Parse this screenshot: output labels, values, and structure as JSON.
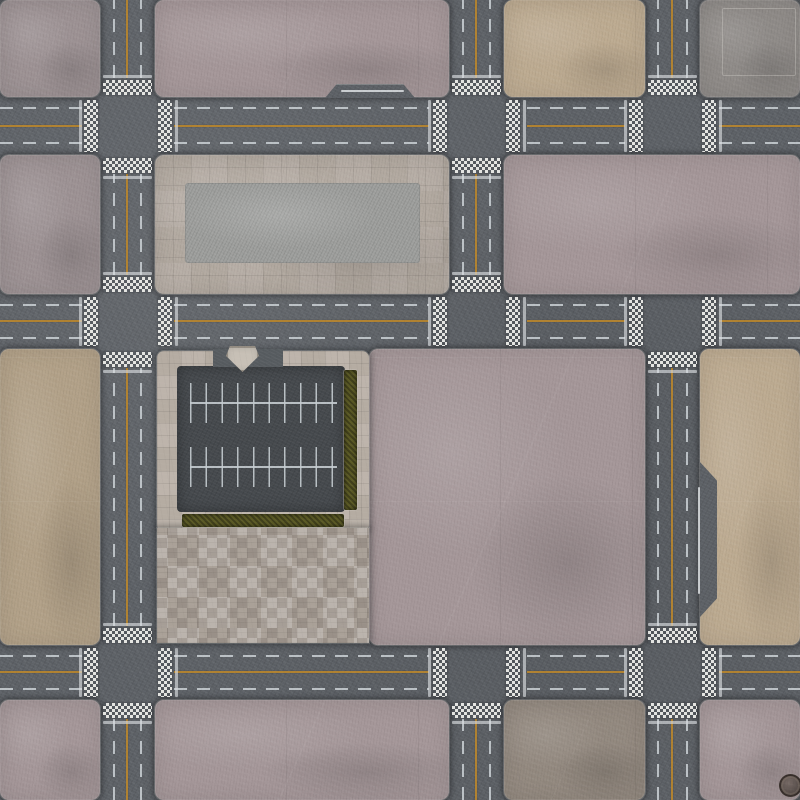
{
  "scene": {
    "title": "city-streets-gaming-mat",
    "width": 800,
    "height": 800,
    "description": "top-down asphalt street grid with concrete city blocks, crosswalks, parking lot, plazas"
  },
  "palette": {
    "asphalt": "#5c6065",
    "parking_asphalt": "#45494d",
    "center_line_yellow": "#b5842f",
    "lane_dash_white": "#ccd2d6",
    "crosswalk_white": "#f0f0ec",
    "block_pink_grey": "#9d9294",
    "block_mauve": "#a59799",
    "block_tan": "#bdab91",
    "block_sand": "#b2a188",
    "block_concrete_grey": "#8f8b88",
    "block_grey_brown": "#93897f",
    "plaza_tile": "#b2a9a0",
    "plaza_pad": "#9d9e9c",
    "paver_sidewalk": "#b5aca2",
    "mosaic_tile": "#aaa198",
    "hedge_green": "#5b5a26"
  },
  "blocks": [
    {
      "name": "block-a1",
      "type": "pink",
      "x": 0,
      "y": 0,
      "w": 100,
      "h": 97
    },
    {
      "name": "block-a2",
      "type": "mauve",
      "x": 155,
      "y": 0,
      "w": 294,
      "h": 97
    },
    {
      "name": "block-a3",
      "type": "tan",
      "x": 504,
      "y": 0,
      "w": 141,
      "h": 97
    },
    {
      "name": "block-a4",
      "type": "grey",
      "x": 700,
      "y": 0,
      "w": 100,
      "h": 97
    },
    {
      "name": "block-b1",
      "type": "pink",
      "x": 0,
      "y": 155,
      "w": 100,
      "h": 139
    },
    {
      "name": "block-b2-tiled-plaza",
      "type": "plaza",
      "x": 155,
      "y": 155,
      "w": 294,
      "h": 139
    },
    {
      "name": "block-b3",
      "type": "mauve",
      "x": 504,
      "y": 155,
      "w": 296,
      "h": 139
    },
    {
      "name": "block-c1",
      "type": "tan2",
      "x": 0,
      "y": 349,
      "w": 100,
      "h": 296
    },
    {
      "name": "block-c3",
      "type": "mauve",
      "x": 369,
      "y": 349,
      "w": 276,
      "h": 296
    },
    {
      "name": "block-c4",
      "type": "tan",
      "x": 700,
      "y": 349,
      "w": 100,
      "h": 296
    },
    {
      "name": "block-d1",
      "type": "mauve",
      "x": 0,
      "y": 700,
      "w": 100,
      "h": 100
    },
    {
      "name": "block-d2",
      "type": "mauve",
      "x": 155,
      "y": 700,
      "w": 294,
      "h": 100
    },
    {
      "name": "block-d3",
      "type": "greybrown",
      "x": 504,
      "y": 700,
      "w": 141,
      "h": 100
    },
    {
      "name": "block-d4",
      "type": "mauve",
      "x": 700,
      "y": 700,
      "w": 100,
      "h": 100
    }
  ],
  "markings": {
    "h_roads": [
      {
        "name": "road-h1",
        "yellow_y": 125,
        "dash_ys": [
          107,
          142
        ],
        "segments": [
          [
            0,
            82
          ],
          [
            174,
            429
          ],
          [
            527,
            625
          ],
          [
            719,
            800
          ]
        ]
      },
      {
        "name": "road-h2",
        "yellow_y": 320,
        "dash_ys": [
          304,
          337
        ],
        "segments": [
          [
            0,
            82
          ],
          [
            174,
            429
          ],
          [
            527,
            625
          ],
          [
            719,
            800
          ]
        ]
      },
      {
        "name": "road-h3",
        "yellow_y": 671,
        "dash_ys": [
          655,
          688
        ],
        "segments": [
          [
            0,
            82
          ],
          [
            174,
            429
          ],
          [
            527,
            625
          ],
          [
            719,
            800
          ]
        ]
      }
    ],
    "v_roads": [
      {
        "name": "road-v1",
        "yellow_x": 126,
        "dash_xs": [
          113,
          140
        ],
        "segments": [
          [
            0,
            78
          ],
          [
            174,
            275
          ],
          [
            368,
            626
          ],
          [
            719,
            800
          ]
        ]
      },
      {
        "name": "road-v2",
        "yellow_x": 475,
        "dash_xs": [
          462,
          489
        ],
        "segments": [
          [
            0,
            78
          ],
          [
            174,
            275
          ],
          [
            719,
            800
          ]
        ]
      },
      {
        "name": "road-v3",
        "yellow_x": 671,
        "dash_xs": [
          657,
          686
        ],
        "segments": [
          [
            0,
            78
          ],
          [
            368,
            626
          ],
          [
            719,
            800
          ]
        ]
      }
    ]
  },
  "crosswalks": [
    {
      "x": 103,
      "y": 80,
      "w": 49,
      "h": 15,
      "o": "N"
    },
    {
      "x": 103,
      "y": 158,
      "w": 49,
      "h": 15,
      "o": "S"
    },
    {
      "x": 84,
      "y": 100,
      "w": 14,
      "h": 52,
      "o": "W"
    },
    {
      "x": 158,
      "y": 100,
      "w": 14,
      "h": 52,
      "o": "E"
    },
    {
      "x": 452,
      "y": 80,
      "w": 49,
      "h": 15,
      "o": "N"
    },
    {
      "x": 452,
      "y": 158,
      "w": 49,
      "h": 15,
      "o": "S"
    },
    {
      "x": 433,
      "y": 100,
      "w": 14,
      "h": 52,
      "o": "W"
    },
    {
      "x": 506,
      "y": 100,
      "w": 14,
      "h": 52,
      "o": "E"
    },
    {
      "x": 648,
      "y": 80,
      "w": 49,
      "h": 15,
      "o": "N"
    },
    {
      "x": 629,
      "y": 100,
      "w": 14,
      "h": 52,
      "o": "W"
    },
    {
      "x": 702,
      "y": 100,
      "w": 14,
      "h": 52,
      "o": "E"
    },
    {
      "x": 103,
      "y": 277,
      "w": 49,
      "h": 15,
      "o": "N"
    },
    {
      "x": 103,
      "y": 352,
      "w": 49,
      "h": 15,
      "o": "S"
    },
    {
      "x": 84,
      "y": 297,
      "w": 14,
      "h": 49,
      "o": "W"
    },
    {
      "x": 158,
      "y": 297,
      "w": 14,
      "h": 49,
      "o": "E"
    },
    {
      "x": 452,
      "y": 277,
      "w": 49,
      "h": 15,
      "o": "N"
    },
    {
      "x": 433,
      "y": 297,
      "w": 14,
      "h": 49,
      "o": "W"
    },
    {
      "x": 506,
      "y": 297,
      "w": 14,
      "h": 49,
      "o": "E"
    },
    {
      "x": 648,
      "y": 352,
      "w": 49,
      "h": 15,
      "o": "S"
    },
    {
      "x": 629,
      "y": 297,
      "w": 14,
      "h": 49,
      "o": "W"
    },
    {
      "x": 702,
      "y": 297,
      "w": 14,
      "h": 49,
      "o": "E"
    },
    {
      "x": 103,
      "y": 628,
      "w": 49,
      "h": 15,
      "o": "N"
    },
    {
      "x": 103,
      "y": 703,
      "w": 49,
      "h": 15,
      "o": "S"
    },
    {
      "x": 84,
      "y": 648,
      "w": 14,
      "h": 49,
      "o": "W"
    },
    {
      "x": 158,
      "y": 648,
      "w": 14,
      "h": 49,
      "o": "E"
    },
    {
      "x": 452,
      "y": 703,
      "w": 49,
      "h": 15,
      "o": "S"
    },
    {
      "x": 433,
      "y": 648,
      "w": 14,
      "h": 49,
      "o": "W"
    },
    {
      "x": 506,
      "y": 648,
      "w": 14,
      "h": 49,
      "o": "E"
    },
    {
      "x": 648,
      "y": 628,
      "w": 49,
      "h": 15,
      "o": "N"
    },
    {
      "x": 648,
      "y": 703,
      "w": 49,
      "h": 15,
      "o": "S"
    },
    {
      "x": 629,
      "y": 648,
      "w": 14,
      "h": 49,
      "o": "W"
    },
    {
      "x": 702,
      "y": 648,
      "w": 14,
      "h": 49,
      "o": "E"
    }
  ],
  "features": [
    {
      "name": "plaza-concrete-pad",
      "cls": "pad-slab",
      "x": 185,
      "y": 183,
      "w": 235,
      "h": 80
    },
    {
      "name": "concrete-inset-border",
      "cls": "inset-sq",
      "x": 722,
      "y": 8,
      "w": 72,
      "h": 66
    },
    {
      "name": "parking-sidewalk",
      "cls": "paver",
      "x": 157,
      "y": 351,
      "w": 212,
      "h": 181
    },
    {
      "name": "parking-asphalt",
      "cls": "pk-asphalt",
      "x": 177,
      "y": 366,
      "w": 168,
      "h": 146
    },
    {
      "name": "mosaic-plaza",
      "cls": "mosaic",
      "x": 157,
      "y": 528,
      "w": 212,
      "h": 115
    },
    {
      "name": "hedge-right",
      "cls": "hedge",
      "x": 344,
      "y": 370,
      "w": 13,
      "h": 140
    },
    {
      "name": "hedge-bottom",
      "cls": "hedge",
      "x": 182,
      "y": 514,
      "w": 162,
      "h": 13
    },
    {
      "name": "parking-driveway",
      "cls": "drive",
      "x": 213,
      "y": 349,
      "w": 70,
      "h": 18
    },
    {
      "name": "traffic-island",
      "cls": "island",
      "x": 226,
      "y": 346,
      "w": 33,
      "h": 26,
      "clip": "polygon(12% 0, 88% 0, 100% 38%, 50% 100%, 0 38%)"
    },
    {
      "name": "parking-ticks-row1",
      "cls": "pticks",
      "x": 190,
      "y": 383,
      "w": 147,
      "h": 40
    },
    {
      "name": "parking-line-row1",
      "cls": "pline",
      "x": 190,
      "y": 402,
      "w": 147,
      "h": 2
    },
    {
      "name": "parking-ticks-row2",
      "cls": "pticks",
      "x": 190,
      "y": 447,
      "w": 147,
      "h": 40
    },
    {
      "name": "parking-line-row2",
      "cls": "pline",
      "x": 190,
      "y": 466,
      "w": 147,
      "h": 2
    },
    {
      "name": "road-layby-bump",
      "cls": "bump",
      "x": 325,
      "y": 84,
      "w": 90,
      "h": 14,
      "clip": "polygon(0 100%, 13% 0, 87% 0, 100% 100%)"
    },
    {
      "name": "layby-white-line",
      "cls": "wline",
      "x": 341,
      "y": 90,
      "w": 63,
      "h": 2
    },
    {
      "name": "road-widening",
      "cls": "widen",
      "x": 700,
      "y": 462,
      "w": 17,
      "h": 155,
      "clip": "polygon(0 0, 100% 12%, 100% 88%, 0 100%)"
    },
    {
      "name": "widening-white-line",
      "cls": "wline",
      "x": 698,
      "y": 487,
      "w": 2,
      "h": 107
    },
    {
      "name": "manufacturer-logo-stamp",
      "cls": "logo",
      "x": 779,
      "y": 774,
      "w": 19,
      "h": 19
    }
  ]
}
